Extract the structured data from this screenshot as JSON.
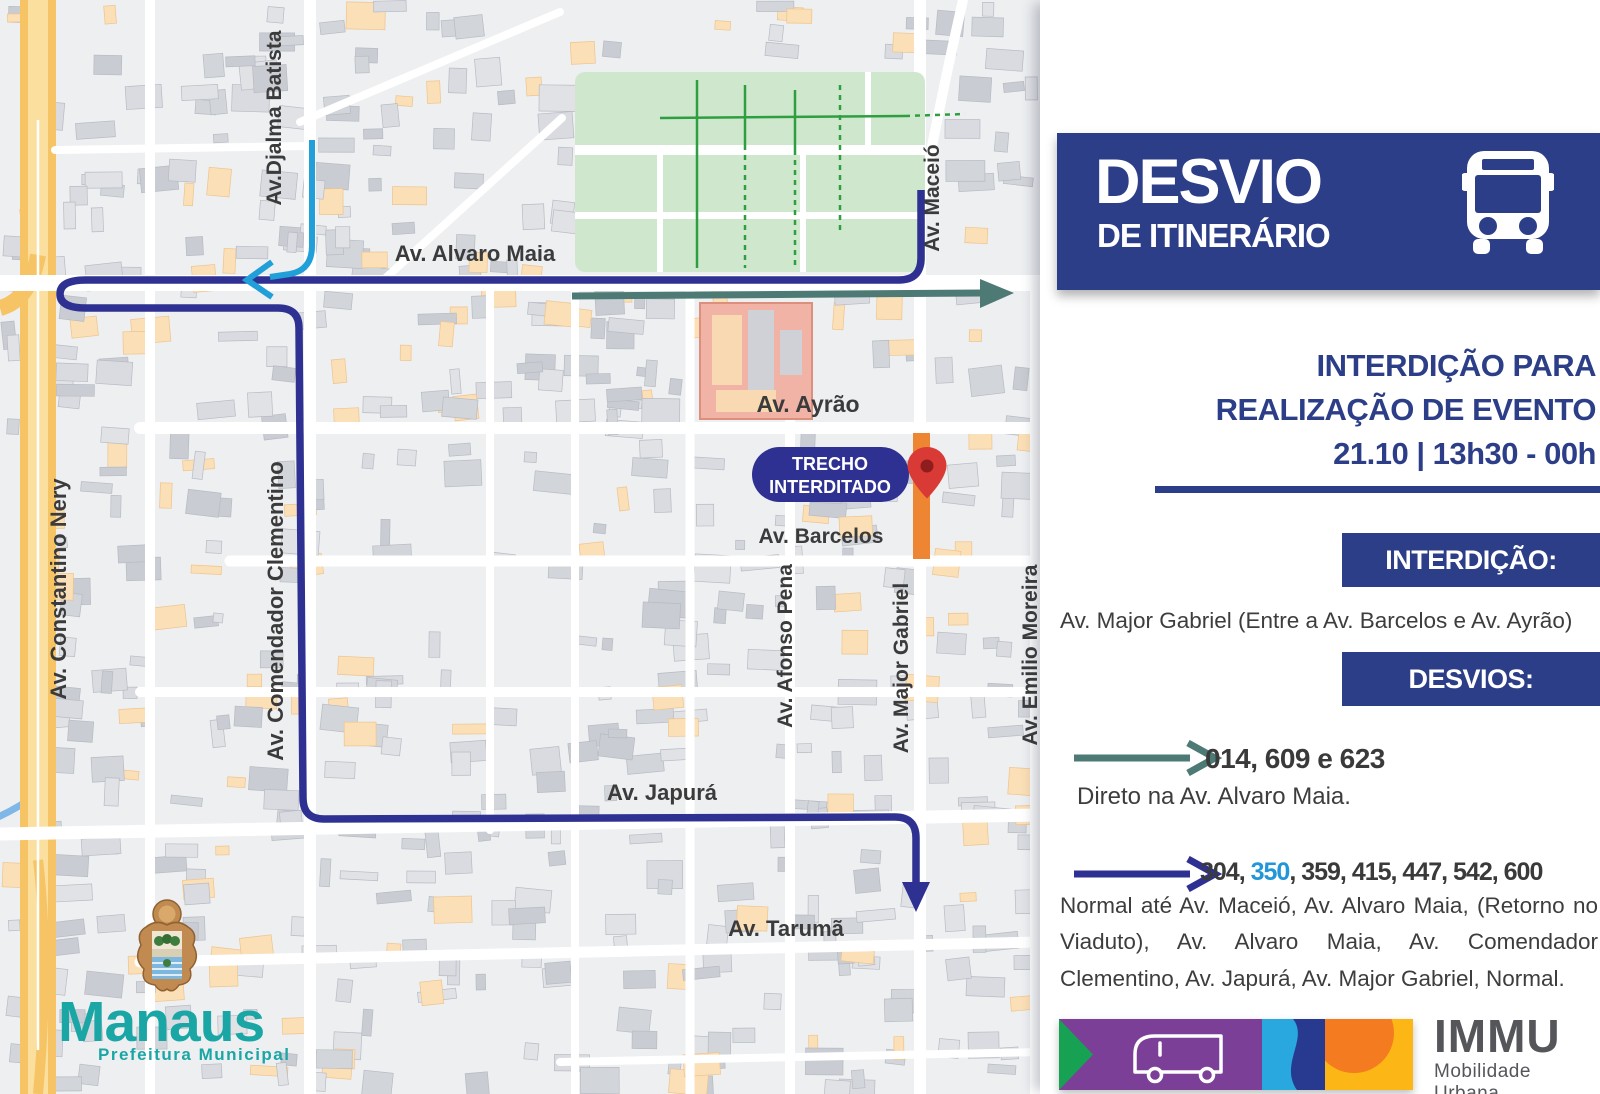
{
  "header": {
    "title": "DESVIO",
    "subtitle": "DE ITINERÁRIO"
  },
  "event": {
    "line1": "INTERDIÇÃO PARA",
    "line2": "REALIZAÇÃO DE EVENTO",
    "line3": "21.10 | 13h30 - 00h"
  },
  "interdicao": {
    "badge": "INTERDIÇÃO:",
    "text": "Av. Major Gabriel (Entre a Av. Barcelos e Av. Ayrão)"
  },
  "desvios": {
    "badge": "DESVIOS:",
    "detour1": {
      "routes": "014, 609 e 623",
      "description": "Direto na Av. Alvaro Maia."
    },
    "detour2": {
      "routes_prefix": "304, ",
      "routes_highlight": "350",
      "routes_suffix": ", 359, 415, 447, 542, 600",
      "description": "Normal até Av. Maceió, Av. Alvaro Maia, (Retorno no Viaduto), Av. Alvaro Maia, Av. Comendador Clementino, Av. Japurá, Av. Major Gabriel, Normal."
    }
  },
  "map": {
    "closure_badge": {
      "line1": "TRECHO",
      "line2": "INTERDITADO"
    },
    "labels": [
      {
        "id": "alvaro-maia",
        "text": "Av. Alvaro Maia",
        "x": 475,
        "y": 261,
        "size": 22,
        "rot": 0
      },
      {
        "id": "djalma-batista",
        "text": "Av.Djalma Batista",
        "x": 281,
        "y": 118,
        "size": 21,
        "rot": -90
      },
      {
        "id": "maceio",
        "text": "Av. Maceió",
        "x": 939,
        "y": 198,
        "size": 21,
        "rot": -90
      },
      {
        "id": "ayrao",
        "text": "Av. Ayrão",
        "x": 808,
        "y": 412,
        "size": 23,
        "rot": 0
      },
      {
        "id": "barcelos",
        "text": "Av. Barcelos",
        "x": 821,
        "y": 543,
        "size": 21,
        "rot": 0
      },
      {
        "id": "constantino-nery",
        "text": "Av. Constantino Nery",
        "x": 66,
        "y": 589,
        "size": 22,
        "rot": -90
      },
      {
        "id": "comendador-clementino",
        "text": "Av. Comendador Clementino",
        "x": 283,
        "y": 611,
        "size": 22,
        "rot": -90
      },
      {
        "id": "afonso-pena",
        "text": "Av. Afonso Pena",
        "x": 792,
        "y": 646,
        "size": 21,
        "rot": -90
      },
      {
        "id": "major-gabriel",
        "text": "Av. Major Gabriel",
        "x": 908,
        "y": 668,
        "size": 21,
        "rot": -90
      },
      {
        "id": "emilio-moreira",
        "text": "Av. Emilio Moreira",
        "x": 1037,
        "y": 655,
        "size": 21,
        "rot": -90
      },
      {
        "id": "japura",
        "text": "Av. Japurá",
        "x": 662,
        "y": 800,
        "size": 22,
        "rot": 0
      },
      {
        "id": "taruma",
        "text": "Av. Tarumã",
        "x": 786,
        "y": 936,
        "size": 22,
        "rot": 0
      }
    ]
  },
  "logos": {
    "manaus": {
      "name": "Manaus",
      "tagline": "Prefeitura Municipal"
    },
    "immu": {
      "name": "IMMU",
      "tagline": "Mobilidade Urbana"
    }
  },
  "colors": {
    "navy": "#2c3e87",
    "route_navy": "#2e3192",
    "route_teal": "#4d7a74",
    "route_lightblue": "#219fd9",
    "highlight_blue": "#2196d8",
    "closure_orange": "#ed8533",
    "pin_red": "#d93a35",
    "map_label": "#3b3b3b",
    "manaus_teal": "#1ba6a6",
    "immu_gray": "#55565a"
  }
}
